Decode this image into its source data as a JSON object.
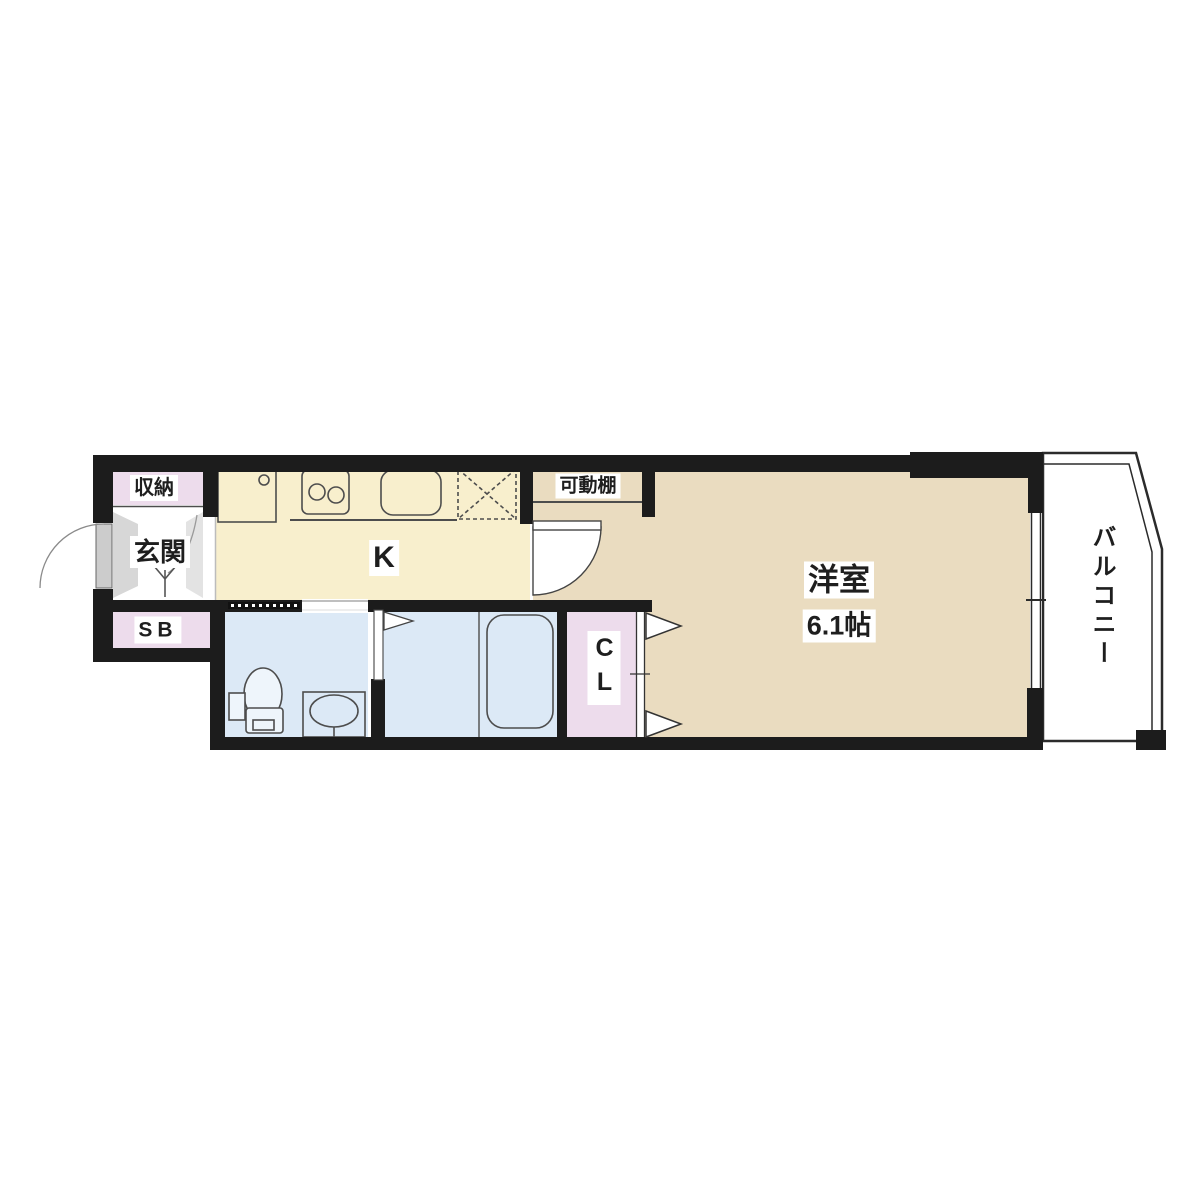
{
  "floor_plan": {
    "rooms": {
      "storage": {
        "label": "収納"
      },
      "entrance": {
        "label": "玄関"
      },
      "shoe_box": {
        "label": "SB"
      },
      "kitchen": {
        "label": "K"
      },
      "movable_shelf": {
        "label": "可動棚"
      },
      "western_room": {
        "label": "洋室",
        "size_label": "6.1帖"
      },
      "closet": {
        "label": "CL"
      },
      "balcony": {
        "label": "バルコニー"
      }
    },
    "colors": {
      "wall": "#1c1c1c",
      "lavender": "#eddcec",
      "cream": "#f8efcd",
      "tan": "#eadcc0",
      "blue": "#dce9f6",
      "fixture": "#4d4d4d"
    }
  }
}
